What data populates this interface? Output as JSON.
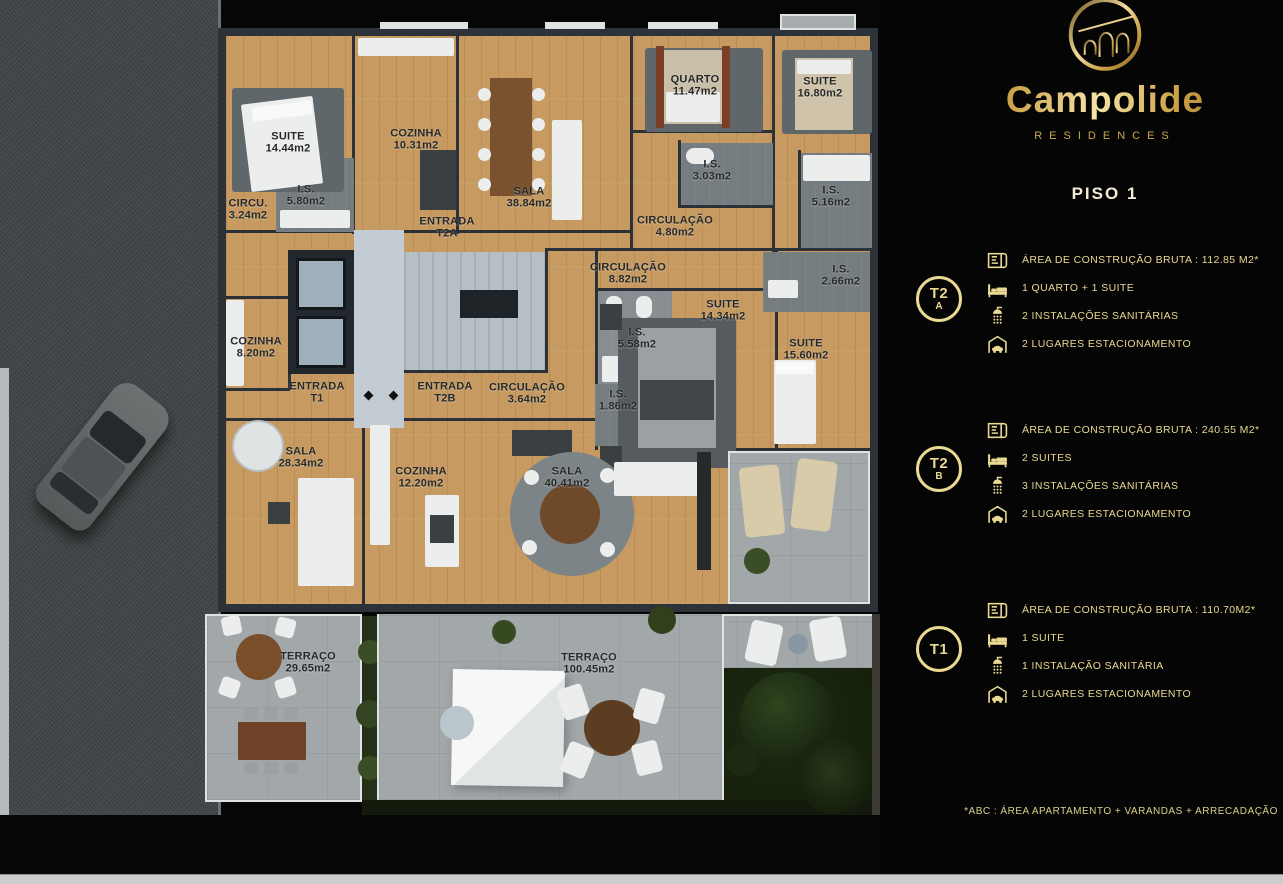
{
  "brand": {
    "name": "Campolide",
    "subtitle": "RESIDENCES"
  },
  "panel": {
    "floor_title": "PISO 1",
    "units": [
      {
        "id": "T2A",
        "badge_top": "T2",
        "badge_bottom": "A",
        "specs": [
          {
            "icon": "floor-plan-icon",
            "text": "ÁREA DE CONSTRUÇÃO BRUTA :  112.85 M2*"
          },
          {
            "icon": "bed-icon",
            "text": "1 QUARTO + 1 SUITE"
          },
          {
            "icon": "shower-icon",
            "text": "2 INSTALAÇÕES SANITÁRIAS"
          },
          {
            "icon": "garage-icon",
            "text": "2 LUGARES ESTACIONAMENTO"
          }
        ]
      },
      {
        "id": "T2B",
        "badge_top": "T2",
        "badge_bottom": "B",
        "specs": [
          {
            "icon": "floor-plan-icon",
            "text": "ÁREA DE CONSTRUÇÃO BRUTA :  240.55 M2*"
          },
          {
            "icon": "bed-icon",
            "text": "2 SUITES"
          },
          {
            "icon": "shower-icon",
            "text": "3 INSTALAÇÕES SANITÁRIAS"
          },
          {
            "icon": "garage-icon",
            "text": "2 LUGARES ESTACIONAMENTO"
          }
        ]
      },
      {
        "id": "T1",
        "badge_top": "T1",
        "badge_bottom": "",
        "specs": [
          {
            "icon": "floor-plan-icon",
            "text": "ÁREA DE CONSTRUÇÃO BRUTA :  110.70M2*"
          },
          {
            "icon": "bed-icon",
            "text": "1 SUITE"
          },
          {
            "icon": "shower-icon",
            "text": "1 INSTALAÇÃO SANITÁRIA"
          },
          {
            "icon": "garage-icon",
            "text": "2 LUGARES ESTACIONAMENTO"
          }
        ]
      }
    ],
    "footnote": "*ABC :  ÁREA APARTAMENTO + VARANDAS + ARRECADAÇÃO"
  },
  "floor_plan": {
    "labels": [
      {
        "name": "SUITE",
        "area": "14.44m2"
      },
      {
        "name": "COZINHA",
        "area": "10.31m2"
      },
      {
        "name": "SALA",
        "area": "38.84m2"
      },
      {
        "name": "QUARTO",
        "area": "11.47m2"
      },
      {
        "name": "SUITE",
        "area": "16.80m2"
      },
      {
        "name": "CIRCU.",
        "area": "3.24m2"
      },
      {
        "name": "I.S.",
        "area": "5.80m2"
      },
      {
        "name": "ENTRADA",
        "area": "T2A"
      },
      {
        "name": "I.S.",
        "area": "3.03m2"
      },
      {
        "name": "CIRCULAÇÃO",
        "area": "4.80m2"
      },
      {
        "name": "I.S.",
        "area": "5.16m2"
      },
      {
        "name": "CIRCULAÇÃO",
        "area": "8.82m2"
      },
      {
        "name": "I.S.",
        "area": "2.66m2"
      },
      {
        "name": "SUITE",
        "area": "14.34m2"
      },
      {
        "name": "I.S.",
        "area": "5.58m2"
      },
      {
        "name": "SUITE",
        "area": "15.60m2"
      },
      {
        "name": "I.S.",
        "area": "1.86m2"
      },
      {
        "name": "COZINHA",
        "area": "8.20m2"
      },
      {
        "name": "ENTRADA",
        "area": "T1"
      },
      {
        "name": "ENTRADA",
        "area": "T2B"
      },
      {
        "name": "CIRCULAÇÃO",
        "area": "3.64m2"
      },
      {
        "name": "SALA",
        "area": "28.34m2"
      },
      {
        "name": "COZINHA",
        "area": "12.20m2"
      },
      {
        "name": "SALA",
        "area": "40.41m2"
      },
      {
        "name": "TERRAÇO",
        "area": "29.65m2"
      },
      {
        "name": "TERRAÇO",
        "area": "100.45m2"
      }
    ]
  },
  "colors": {
    "gold": "#e9d992",
    "gold_dark": "#a97f2e",
    "gold_light": "#f3df9f",
    "cream": "#f3ecd3",
    "wood": "#c69a60"
  }
}
